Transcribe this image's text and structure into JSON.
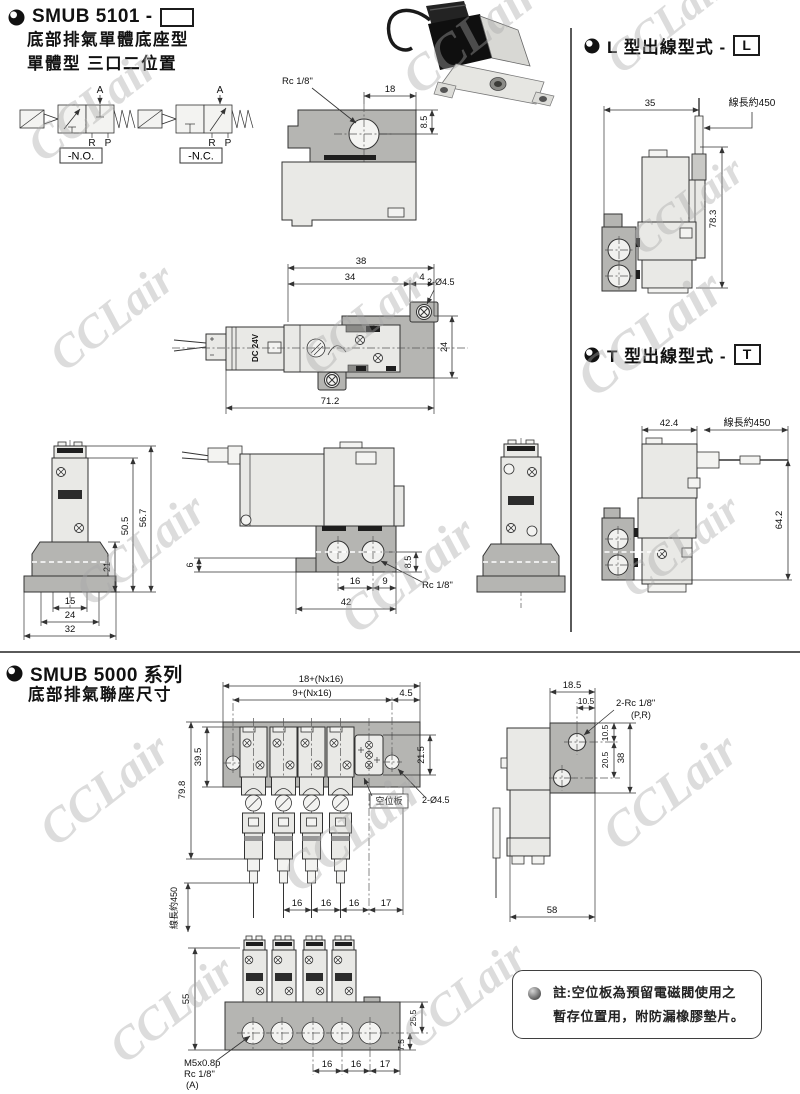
{
  "page": {
    "watermark": "CCLair"
  },
  "top_section": {
    "title": "SMUB 5101 -",
    "subtitle_line1": "底部排氣單體底座型",
    "subtitle_line2": "單體型 三口二位置",
    "symbols": {
      "no_label": "-N.O.",
      "nc_label": "-N.C.",
      "port_a": "A",
      "port_r": "R",
      "port_p": "P"
    },
    "view_base_detail": {
      "rc_label": "Rc 1/8\"",
      "dim_18": "18",
      "dim_8_5": "8.5"
    },
    "view_plan": {
      "dim_38": "38",
      "dim_34": "34",
      "dim_4": "4",
      "holes_label": "2-Ø4.5",
      "dim_24": "24",
      "dim_71_2": "71.2",
      "body_text": "DC 24V"
    },
    "view_front": {
      "dim_50_5": "50.5",
      "dim_56_7": "56.7",
      "dim_21": "21",
      "dim_15": "15",
      "dim_24": "24",
      "dim_32": "32"
    },
    "view_side": {
      "dim_6": "6",
      "dim_16": "16",
      "dim_9": "9",
      "dim_42": "42",
      "dim_8_5": "8.5",
      "rc_label": "Rc 1/8\""
    }
  },
  "l_type": {
    "heading": "L 型出線型式 -",
    "badge": "L",
    "dim_35": "35",
    "wire_label": "線長約450",
    "dim_78_3": "78.3"
  },
  "t_type": {
    "heading": "T 型出線型式 -",
    "badge": "T",
    "dim_42_4": "42.4",
    "wire_label": "線長約450",
    "dim_64_2": "64.2"
  },
  "bottom_section": {
    "title": "SMUB 5000 系列",
    "subtitle": "底部排氣聯座尺寸",
    "view_plan": {
      "dim_outer": "18+(Nx16)",
      "dim_inner": "9+(Nx16)",
      "dim_4_5": "4.5",
      "dim_39_5": "39.5",
      "dim_79_8": "79.8",
      "dim_21_5": "21.5",
      "spare_label": "空位板",
      "holes_label": "2-Ø4.5",
      "wire_label": "線長約450",
      "dim_16": "16",
      "dim_17": "17"
    },
    "view_side": {
      "dim_18_5": "18.5",
      "dim_10_5_top": "10.5",
      "rc_label": "2-Rc 1/8\"",
      "rc_sub": "(P,R)",
      "dim_10_5": "10.5",
      "dim_20_5": "20.5",
      "dim_38": "38",
      "dim_58": "58"
    },
    "view_front": {
      "dim_55": "55",
      "dim_25_5": "25.5",
      "dim_7_5": "7.5",
      "dim_16": "16",
      "dim_17": "17",
      "thread_label1": "M5x0.8p",
      "thread_label2": "Rc 1/8\"",
      "thread_label3": "(A)"
    },
    "note": {
      "line1": "註:空位板為預留電磁閥使用之",
      "line2": "暫存位置用，附防漏橡膠墊片。"
    }
  }
}
